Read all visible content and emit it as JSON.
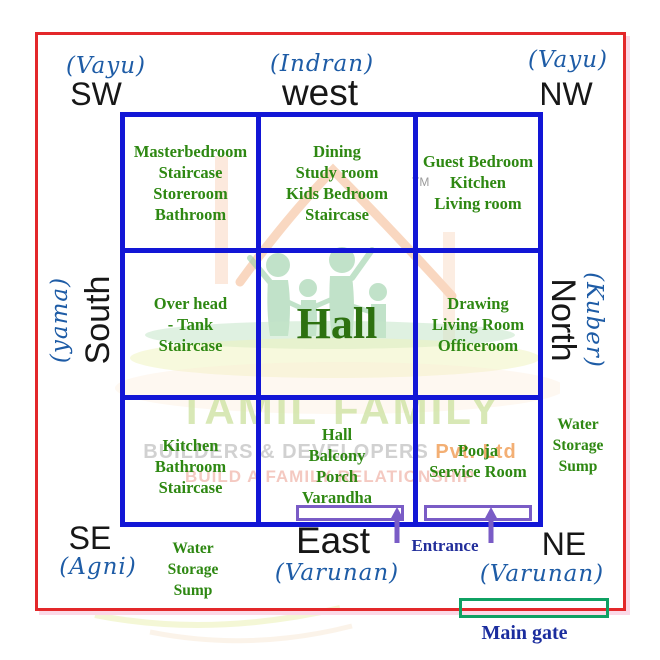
{
  "directions": {
    "sw": {
      "deity": "(Vayu)",
      "label": "SW"
    },
    "west": {
      "deity": "(Indran)",
      "label": "west"
    },
    "nw": {
      "deity": "(Vayu)",
      "label": "NW"
    },
    "south": {
      "deity": "(yama)",
      "label": "South"
    },
    "north": {
      "deity": "(Kuber)",
      "label": "North"
    },
    "se": {
      "deity": "(Agni)",
      "label": "SE"
    },
    "east": {
      "deity": "(Varunan)",
      "label": "East"
    },
    "ne": {
      "deity": "(Varunan)",
      "label": "NE"
    }
  },
  "grid": {
    "cells": [
      {
        "name": "southwest-row-west",
        "lines": [
          "Masterbedroom",
          "Staircase",
          "Storeroom",
          "Bathroom"
        ]
      },
      {
        "name": "west",
        "lines": [
          "Dining",
          "Study room",
          "Kids Bedroom",
          "Staircase"
        ]
      },
      {
        "name": "northwest",
        "lines": [
          "Guest Bedroom",
          "Kitchen",
          "Living room"
        ]
      },
      {
        "name": "south",
        "lines": [
          "Over head",
          "- Tank",
          "Staircase"
        ]
      },
      {
        "name": "center",
        "lines": [
          "Hall"
        ]
      },
      {
        "name": "north",
        "lines": [
          "Drawing",
          "Living Room",
          "Officeroom"
        ]
      },
      {
        "name": "southeast",
        "lines": [
          "Kitchen",
          "Bathroom",
          "Staircase"
        ]
      },
      {
        "name": "east",
        "lines": [
          "Hall",
          "Balcony",
          "Porch",
          "Varandha"
        ]
      },
      {
        "name": "northeast",
        "lines": [
          "Pooja",
          "Service Room"
        ]
      }
    ]
  },
  "annotations": {
    "water_sump_right": {
      "lines": [
        "Water",
        "Storage",
        "Sump"
      ]
    },
    "water_sump_bottom": {
      "lines": [
        "Water",
        "Storage",
        "Sump"
      ]
    },
    "entrance": "Entrance",
    "main_gate": "Main gate"
  },
  "watermark": {
    "brand": "TAMIL FAMILY",
    "builders": "BUILDERS & DEVELOPERS ",
    "pvt": "Pvt. Ltd",
    "tagline": "BUILD A FAMILY RELATIONSHIP",
    "tm": "TM"
  },
  "colors": {
    "plot_border_red": "#e3282a",
    "grid_blue": "#1216d6",
    "room_text_green": "#2e8812",
    "deity_blue": "#1e5ca6",
    "direction_black": "#171717",
    "entrance_purple": "#7a5cc6",
    "main_gate_green": "#0fa163",
    "label_navy": "#222e9b"
  }
}
